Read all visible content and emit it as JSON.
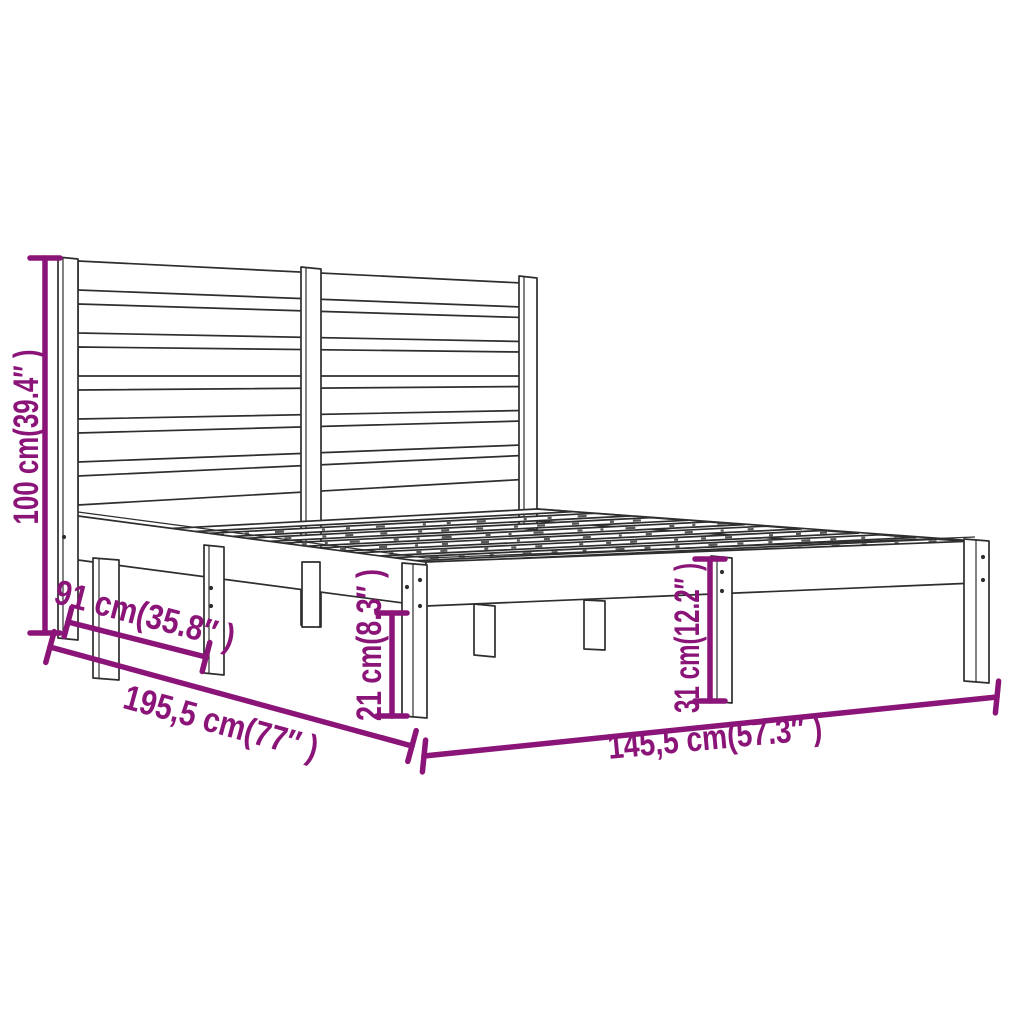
{
  "page": {
    "type": "product dimension diagram",
    "subject": "wooden bed frame with slatted headboard, isometric line drawing",
    "background_color": "#ffffff"
  },
  "colors": {
    "dimension_accent": "#8b1478",
    "drawing_line": "#2e2e2e"
  },
  "dimensions": {
    "headboard_height": {
      "label": "100 cm(39.4″ )",
      "value_cm": "100",
      "value_inch": "39.4″"
    },
    "side_section": {
      "label": "91 cm(35.8″ )",
      "value_cm": "91",
      "value_inch": "35.8″"
    },
    "length": {
      "label": "195,5 cm(77″ )",
      "value_cm": "195,5",
      "value_inch": "77″"
    },
    "leg_height": {
      "label": "21 cm(8.3″ )",
      "value_cm": "21",
      "value_inch": "8.3″"
    },
    "base_height": {
      "label": "31 cm(12.2″ )",
      "value_cm": "31",
      "value_inch": "12.2″"
    },
    "width": {
      "label": "145,5 cm(57.3″ )",
      "value_cm": "145,5",
      "value_inch": "57.3″"
    }
  }
}
